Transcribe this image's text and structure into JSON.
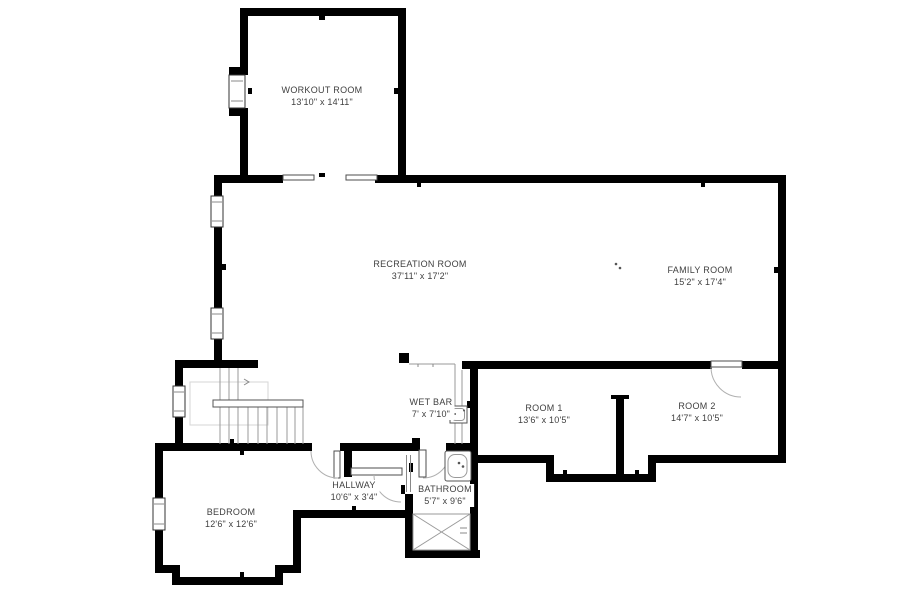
{
  "page": {
    "type": "floor-plan",
    "background": "#ffffff"
  },
  "floorplan": {
    "rooms": [
      {
        "name": "WORKOUT ROOM",
        "dims": "13'10\" x 14'11\""
      },
      {
        "name": "RECREATION ROOM",
        "dims": "37'11\" x 17'2\""
      },
      {
        "name": "FAMILY ROOM",
        "dims": "15'2\" x 17'4\""
      },
      {
        "name": "WET BAR",
        "dims": "7' x 7'10\""
      },
      {
        "name": "ROOM 1",
        "dims": "13'6\" x 10'5\""
      },
      {
        "name": "ROOM 2",
        "dims": "14'7\" x 10'5\""
      },
      {
        "name": "HALLWAY",
        "dims": "10'6\" x 3'4\""
      },
      {
        "name": "BATHROOM",
        "dims": "5'7\" x 9'6\""
      },
      {
        "name": "BEDROOM",
        "dims": "12'6\" x 12'6\""
      }
    ],
    "colors": {
      "wall": "#000000",
      "thin_line": "#9a9a9a",
      "label_text": "#3f3f3f",
      "background": "#ffffff"
    },
    "fixtures": [
      "staircase",
      "stair-railing",
      "wet-bar-sink",
      "bathtub",
      "toilet",
      "shower",
      "window",
      "door-swing",
      "pocket-door",
      "closet-bypass-door"
    ]
  }
}
